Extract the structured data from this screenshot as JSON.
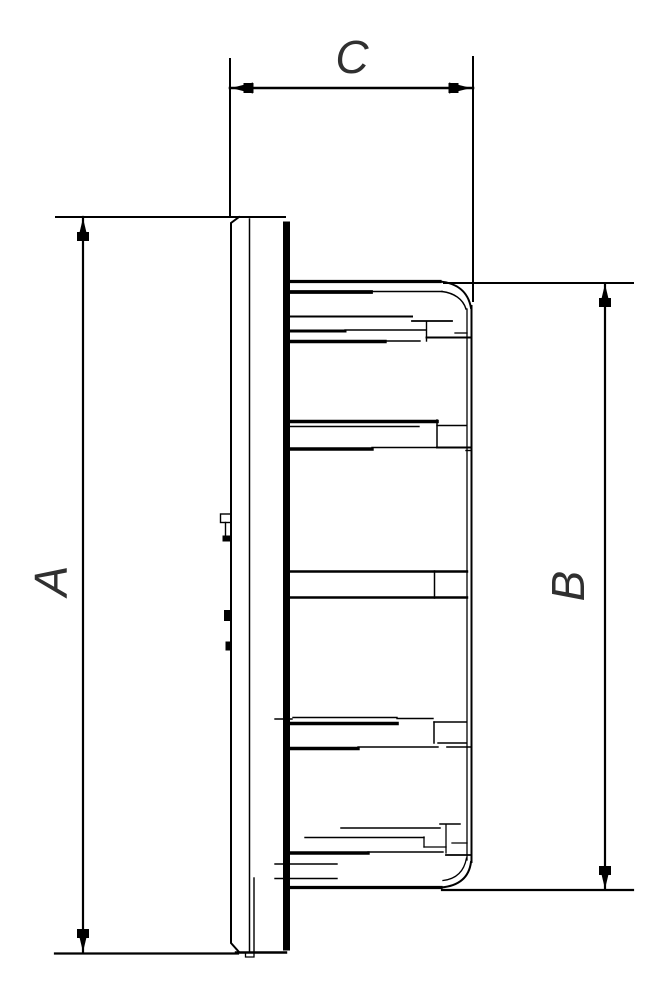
{
  "drawing": {
    "labels": {
      "dim_a": "A",
      "dim_b": "B",
      "dim_c": "C"
    },
    "colors": {
      "line": "#000000",
      "label": "#303030",
      "background": "#ffffff"
    }
  }
}
